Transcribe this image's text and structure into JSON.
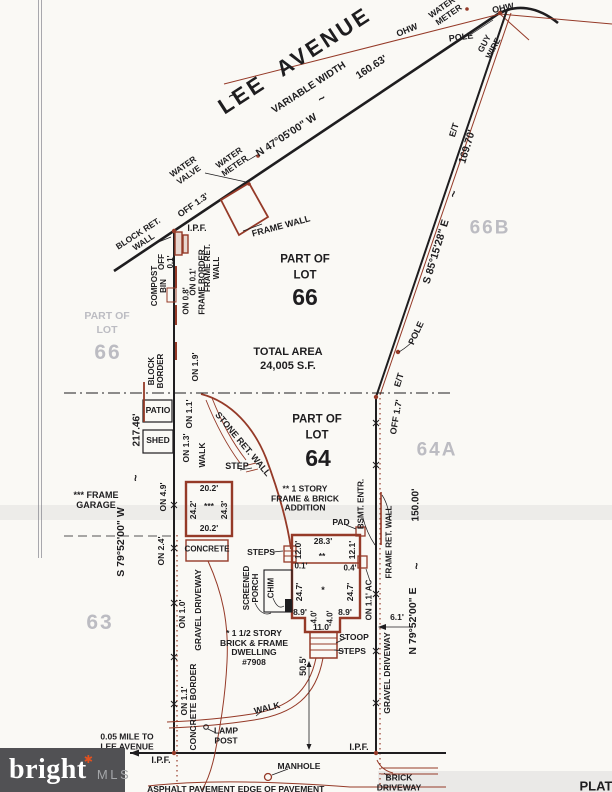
{
  "colors": {
    "paper": "#faf9f5",
    "ink": "#1e1d1f",
    "red": "#953a28",
    "gray": "#b2b2ba",
    "band": "rgba(125,125,132,0.11)",
    "logo_bg": "#515154",
    "logo_accent": "#e2511f"
  },
  "logo": {
    "brand": "bright",
    "asterisk": "✱",
    "suffix": "MLS"
  },
  "labels": [
    {
      "n": "lee-avenue",
      "t": "LEE  AVENUE",
      "x": 295,
      "y": 61,
      "r": -33,
      "s": 22,
      "ls": 3
    },
    {
      "n": "variable-width",
      "t": "VARIABLE WIDTH",
      "x": 309,
      "y": 88,
      "r": -33,
      "s": 10
    },
    {
      "n": "tilde-variable-width",
      "t": "~",
      "x": 322,
      "y": 99,
      "r": -33,
      "s": 12
    },
    {
      "n": "tilde-lee",
      "t": "~",
      "x": 232,
      "y": 96,
      "r": -33,
      "s": 12
    },
    {
      "n": "bearing-n47",
      "t": "N 47°05'00\" W",
      "x": 287,
      "y": 136,
      "r": -33,
      "s": 10.5
    },
    {
      "n": "dim-160-63",
      "t": "160.63'",
      "x": 372,
      "y": 68,
      "r": -33,
      "s": 10.5
    },
    {
      "n": "ohw-label-1",
      "t": "OHW",
      "x": 407,
      "y": 30,
      "r": -22,
      "s": 9
    },
    {
      "n": "ohw-label-2",
      "t": "OHW",
      "x": 503,
      "y": 8,
      "r": -12,
      "s": 9
    },
    {
      "n": "water-meter-top-label",
      "t": "WATER-\nMETER",
      "x": 446,
      "y": 11,
      "r": -35,
      "s": 8.5
    },
    {
      "n": "pole-label-top",
      "t": "POLE",
      "x": 461,
      "y": 37,
      "r": -8,
      "s": 9
    },
    {
      "n": "guy-wire-label",
      "t": "GUY\nWIRE",
      "x": 489,
      "y": 46,
      "r": -62,
      "s": 8.5
    },
    {
      "n": "et-label-top",
      "t": "E/T",
      "x": 454,
      "y": 130,
      "r": -73,
      "s": 9
    },
    {
      "n": "dim-169-70",
      "t": "169.70'",
      "x": 468,
      "y": 147,
      "r": -73,
      "s": 10.5
    },
    {
      "n": "tilde-s85",
      "t": "~",
      "x": 454,
      "y": 194,
      "r": -73,
      "s": 12
    },
    {
      "n": "bearing-s85",
      "t": "S 85°15'28\" E",
      "x": 437,
      "y": 252,
      "r": -73,
      "s": 10.5
    },
    {
      "n": "lot-66b",
      "t": "66B",
      "x": 490,
      "y": 228,
      "r": 0,
      "s": 19,
      "c": "gray",
      "ls": 2
    },
    {
      "n": "pole-label-mid",
      "t": "POLE",
      "x": 416,
      "y": 333,
      "r": -65,
      "s": 9
    },
    {
      "n": "et-label-mid",
      "t": "E/T",
      "x": 399,
      "y": 380,
      "r": -73,
      "s": 9
    },
    {
      "n": "off-1-7",
      "t": "OFF 1.7'",
      "x": 396,
      "y": 417,
      "r": -80,
      "s": 9
    },
    {
      "n": "lot-64a",
      "t": "64A",
      "x": 437,
      "y": 450,
      "r": 0,
      "s": 19,
      "c": "gray",
      "ls": 2
    },
    {
      "n": "water-valve-label",
      "t": "WATER\nVALVE",
      "x": 186,
      "y": 171,
      "r": -35,
      "s": 8.5
    },
    {
      "n": "water-meter-label",
      "t": "WATER\nMETER",
      "x": 232,
      "y": 162,
      "r": -35,
      "s": 8.5
    },
    {
      "n": "off-1-3",
      "t": "OFF 1.3'",
      "x": 193,
      "y": 205,
      "r": -35,
      "s": 9
    },
    {
      "n": "block-ret-wall-label",
      "t": "BLOCK RET.\nWALL",
      "x": 141,
      "y": 238,
      "r": -33,
      "s": 8.5
    },
    {
      "n": "ipf-top-label",
      "t": "I.P.F.",
      "x": 197,
      "y": 228,
      "r": 0,
      "s": 9
    },
    {
      "n": "frame-wall-label",
      "t": "FRAME WALL",
      "x": 281,
      "y": 226,
      "r": -15,
      "s": 9
    },
    {
      "n": "off-0-1",
      "t": "OFF\n0.1'",
      "x": 167,
      "y": 262,
      "r": -90,
      "s": 8
    },
    {
      "n": "compost-bin-label",
      "t": "COMPOST\nBIN",
      "x": 160,
      "y": 286,
      "r": -90,
      "s": 8
    },
    {
      "n": "on-0-8",
      "t": "ON 0.8'",
      "x": 187,
      "y": 301,
      "r": -90,
      "s": 8
    },
    {
      "n": "on-0-1",
      "t": "ON 0.1'",
      "x": 194,
      "y": 282,
      "r": -90,
      "s": 8
    },
    {
      "n": "frame-border-label-1",
      "t": "FRAME BORDER",
      "x": 203,
      "y": 282,
      "r": -90,
      "s": 8
    },
    {
      "n": "frame-ret-wall-label-1",
      "t": "FRAME RET.\nWALL",
      "x": 213,
      "y": 268,
      "r": -90,
      "s": 8
    },
    {
      "n": "block-border-label",
      "t": "BLOCK\nBORDER",
      "x": 157,
      "y": 371,
      "r": -90,
      "s": 8
    },
    {
      "n": "on-1-9",
      "t": "ON 1.9'",
      "x": 196,
      "y": 367,
      "r": -90,
      "s": 8.5
    },
    {
      "n": "on-1-1-top",
      "t": "ON 1.1'",
      "x": 190,
      "y": 414,
      "r": -90,
      "s": 8.5
    },
    {
      "n": "patio-label",
      "t": "PATIO",
      "x": 158,
      "y": 411,
      "r": 0,
      "s": 8.5
    },
    {
      "n": "dim-217-46",
      "t": "217.46'",
      "x": 137,
      "y": 430,
      "r": -90,
      "s": 10
    },
    {
      "n": "shed-label",
      "t": "SHED",
      "x": 158,
      "y": 441,
      "r": 0,
      "s": 8.5
    },
    {
      "n": "on-1-3",
      "t": "ON 1.3'",
      "x": 187,
      "y": 448,
      "r": -90,
      "s": 8.5
    },
    {
      "n": "walk-label-upper",
      "t": "WALK",
      "x": 203,
      "y": 455,
      "r": -90,
      "s": 8.5
    },
    {
      "n": "stone-ret-wall-label",
      "t": "STONE RET. WALL",
      "x": 243,
      "y": 444,
      "r": 50,
      "s": 9
    },
    {
      "n": "step-label",
      "t": "STEP",
      "x": 237,
      "y": 466,
      "r": 0,
      "s": 9
    },
    {
      "n": "on-4-9",
      "t": "ON 4.9'",
      "x": 164,
      "y": 497,
      "r": -90,
      "s": 8.5
    },
    {
      "n": "tilde-s79w",
      "t": "~",
      "x": 136,
      "y": 478,
      "r": -90,
      "s": 12
    },
    {
      "n": "frame-garage-label",
      "t": "*** FRAME\nGARAGE",
      "x": 96,
      "y": 500,
      "r": 0,
      "s": 9
    },
    {
      "n": "bearing-s79w",
      "t": "S 79°52'00\" W",
      "x": 122,
      "y": 542,
      "r": -90,
      "s": 10.5
    },
    {
      "n": "lot-63",
      "t": "63",
      "x": 100,
      "y": 623,
      "r": 0,
      "s": 21,
      "c": "gray",
      "ls": 2
    },
    {
      "n": "garage-dim-top",
      "t": "20.2'",
      "x": 209,
      "y": 489,
      "r": 0,
      "s": 8.5
    },
    {
      "n": "garage-dim-left",
      "t": "24.2'",
      "x": 194,
      "y": 510,
      "r": -90,
      "s": 8.5
    },
    {
      "n": "garage-marker",
      "t": "***",
      "x": 209,
      "y": 507,
      "r": 0,
      "s": 8.5
    },
    {
      "n": "garage-dim-right",
      "t": "24.3'",
      "x": 225,
      "y": 510,
      "r": -90,
      "s": 8.5
    },
    {
      "n": "garage-dim-bottom",
      "t": "20.2'",
      "x": 209,
      "y": 529,
      "r": 0,
      "s": 8.5
    },
    {
      "n": "on-2-4",
      "t": "ON 2.4'",
      "x": 162,
      "y": 551,
      "r": -90,
      "s": 8.5
    },
    {
      "n": "concrete-label",
      "t": "CONCRETE",
      "x": 207,
      "y": 550,
      "r": 0,
      "s": 8
    },
    {
      "n": "steps-label-1",
      "t": "STEPS",
      "x": 261,
      "y": 553,
      "r": 0,
      "s": 8.5
    },
    {
      "n": "screened-porch-label",
      "t": "SCREENED\nPORCH",
      "x": 252,
      "y": 588,
      "r": -90,
      "s": 8
    },
    {
      "n": "chim-label",
      "t": "CHIM",
      "x": 272,
      "y": 588,
      "r": -90,
      "s": 8
    },
    {
      "n": "house-dim-12-0",
      "t": "12.0'",
      "x": 299,
      "y": 550,
      "r": -90,
      "s": 8.5
    },
    {
      "n": "house-dim-28-3",
      "t": "28.3'",
      "x": 323,
      "y": 542,
      "r": 0,
      "s": 8.5
    },
    {
      "n": "house-dim-12-1",
      "t": "12.1'",
      "x": 353,
      "y": 550,
      "r": -90,
      "s": 8.5
    },
    {
      "n": "house-marker-2",
      "t": "**",
      "x": 322,
      "y": 557,
      "r": 0,
      "s": 8.5
    },
    {
      "n": "house-dim-0-1",
      "t": "0.1'",
      "x": 301,
      "y": 567,
      "r": 0,
      "s": 8
    },
    {
      "n": "house-dim-0-4",
      "t": "0.4'",
      "x": 350,
      "y": 569,
      "r": 0,
      "s": 8
    },
    {
      "n": "house-dim-24-7-l",
      "t": "24.7'",
      "x": 300,
      "y": 592,
      "r": -90,
      "s": 8.5
    },
    {
      "n": "house-marker-1",
      "t": "*",
      "x": 323,
      "y": 590,
      "r": 0,
      "s": 9
    },
    {
      "n": "house-dim-24-7-r",
      "t": "24.7'",
      "x": 351,
      "y": 592,
      "r": -90,
      "s": 8.5
    },
    {
      "n": "house-dim-8-9-l",
      "t": "8.9'",
      "x": 300,
      "y": 613,
      "r": 0,
      "s": 8.5
    },
    {
      "n": "house-dim-4-0-l",
      "t": "4.0'",
      "x": 315,
      "y": 617,
      "r": -90,
      "s": 8
    },
    {
      "n": "house-dim-4-0-r",
      "t": "4.0'",
      "x": 331,
      "y": 617,
      "r": -90,
      "s": 8
    },
    {
      "n": "house-dim-8-9-r",
      "t": "8.9'",
      "x": 345,
      "y": 613,
      "r": 0,
      "s": 8.5
    },
    {
      "n": "house-dim-11-0",
      "t": "11.0'",
      "x": 322,
      "y": 628,
      "r": 0,
      "s": 8.5
    },
    {
      "n": "pad-label",
      "t": "PAD",
      "x": 341,
      "y": 523,
      "r": 0,
      "s": 8.5
    },
    {
      "n": "bsmt-entr-label",
      "t": "BSMT. ENTR.",
      "x": 362,
      "y": 504,
      "r": -90,
      "s": 8
    },
    {
      "n": "frame-ret-wall-label-2",
      "t": "FRAME RET. WALL",
      "x": 390,
      "y": 542,
      "r": -90,
      "s": 8
    },
    {
      "n": "dim-150-00",
      "t": "150.00'",
      "x": 416,
      "y": 505,
      "r": -90,
      "s": 10
    },
    {
      "n": "tilde-n79e",
      "t": "~",
      "x": 417,
      "y": 566,
      "r": -90,
      "s": 12
    },
    {
      "n": "bearing-n79e",
      "t": "N 79°52'00\" E",
      "x": 414,
      "y": 621,
      "r": -90,
      "s": 10.5
    },
    {
      "n": "on-1-1-ac",
      "t": "ON 1.1' AC",
      "x": 370,
      "y": 600,
      "r": -90,
      "s": 8
    },
    {
      "n": "dim-6-1",
      "t": "6.1'",
      "x": 397,
      "y": 618,
      "r": 0,
      "s": 8.5
    },
    {
      "n": "gravel-driveway-label-r",
      "t": "GRAVEL DRIVEWAY",
      "x": 388,
      "y": 673,
      "r": -90,
      "s": 8.5
    },
    {
      "n": "stoop-label",
      "t": "STOOP",
      "x": 354,
      "y": 638,
      "r": 0,
      "s": 8.5
    },
    {
      "n": "steps-label-2",
      "t": "STEPS",
      "x": 352,
      "y": 652,
      "r": 0,
      "s": 8.5
    },
    {
      "n": "dwelling-note",
      "t": "* 1 1/2 STORY\nBRICK & FRAME\nDWELLING\n#7908",
      "x": 254,
      "y": 648,
      "r": 0,
      "s": 8.5
    },
    {
      "n": "dim-50-5",
      "t": "50.5'",
      "x": 303,
      "y": 666,
      "r": -90,
      "s": 9
    },
    {
      "n": "on-1-0",
      "t": "ON 1.0'",
      "x": 183,
      "y": 614,
      "r": -90,
      "s": 8.5
    },
    {
      "n": "gravel-driveway-label-l",
      "t": "GRAVEL DRIVEWAY",
      "x": 199,
      "y": 610,
      "r": -90,
      "s": 8.5
    },
    {
      "n": "walk-label-lower",
      "t": "WALK",
      "x": 267,
      "y": 708,
      "r": -14,
      "s": 9
    },
    {
      "n": "on-1-1-bottom",
      "t": "ON 1.1'",
      "x": 185,
      "y": 701,
      "r": -90,
      "s": 8.5
    },
    {
      "n": "concrete-border-label",
      "t": "CONCRETE BORDER",
      "x": 194,
      "y": 707,
      "r": -90,
      "s": 8.5
    },
    {
      "n": "lamp-post-label",
      "t": "LAMP\nPOST",
      "x": 226,
      "y": 736,
      "r": 0,
      "s": 8.5
    },
    {
      "n": "mile-note",
      "t": "0.05 MILE TO\nLEE AVENUE",
      "x": 127,
      "y": 742,
      "r": 0,
      "s": 8.5
    },
    {
      "n": "ipf-bottom-left",
      "t": "I.P.F.",
      "x": 161,
      "y": 760,
      "r": 0,
      "s": 9
    },
    {
      "n": "ipf-bottom-right",
      "t": "I.P.F.",
      "x": 359,
      "y": 747,
      "r": 0,
      "s": 9
    },
    {
      "n": "manhole-label",
      "t": "MANHOLE",
      "x": 299,
      "y": 767,
      "r": 0,
      "s": 8.5
    },
    {
      "n": "brick-driveway-label",
      "t": "BRICK\nDRIVEWAY",
      "x": 399,
      "y": 783,
      "r": 0,
      "s": 8.5
    },
    {
      "n": "asphalt-label",
      "t": "ASPHALT PAVEMENT",
      "x": 191,
      "y": 790,
      "r": 0,
      "s": 8.5
    },
    {
      "n": "edge-pavement-label",
      "t": "EDGE OF PAVEMENT",
      "x": 281,
      "y": 790,
      "r": 0,
      "s": 8.5
    },
    {
      "n": "part-of-lot-66-gray-a",
      "t": "PART OF",
      "x": 107,
      "y": 317,
      "r": 0,
      "s": 10.5,
      "c": "gray"
    },
    {
      "n": "part-of-lot-66-gray-b",
      "t": "LOT",
      "x": 107,
      "y": 331,
      "r": 0,
      "s": 10.5,
      "c": "gray"
    },
    {
      "n": "lot-66-gray",
      "t": "66",
      "x": 108,
      "y": 353,
      "r": 0,
      "s": 21,
      "c": "gray",
      "ls": 2
    },
    {
      "n": "part-of-lot-66-a",
      "t": "PART OF",
      "x": 305,
      "y": 260,
      "r": 0,
      "s": 11.5
    },
    {
      "n": "part-of-lot-66-b",
      "t": "LOT",
      "x": 305,
      "y": 276,
      "r": 0,
      "s": 11.5
    },
    {
      "n": "lot-66-black",
      "t": "66",
      "x": 305,
      "y": 298,
      "r": 0,
      "s": 23
    },
    {
      "n": "total-area-a",
      "t": "TOTAL AREA",
      "x": 288,
      "y": 352,
      "r": 0,
      "s": 11
    },
    {
      "n": "total-area-b",
      "t": "24,005 S.F.",
      "x": 288,
      "y": 366,
      "r": 0,
      "s": 11
    },
    {
      "n": "part-of-lot-64-a",
      "t": "PART OF",
      "x": 317,
      "y": 420,
      "r": 0,
      "s": 11.5
    },
    {
      "n": "part-of-lot-64-b",
      "t": "LOT",
      "x": 317,
      "y": 436,
      "r": 0,
      "s": 11.5
    },
    {
      "n": "lot-64-black",
      "t": "64",
      "x": 318,
      "y": 459,
      "r": 0,
      "s": 23
    },
    {
      "n": "addition-note",
      "t": "** 1 STORY\nFRAME & BRICK\nADDITION",
      "x": 305,
      "y": 499,
      "r": 0,
      "s": 8.5
    },
    {
      "n": "plat-label",
      "t": "PLAT",
      "x": 596,
      "y": 787,
      "r": 0,
      "s": 13
    }
  ]
}
